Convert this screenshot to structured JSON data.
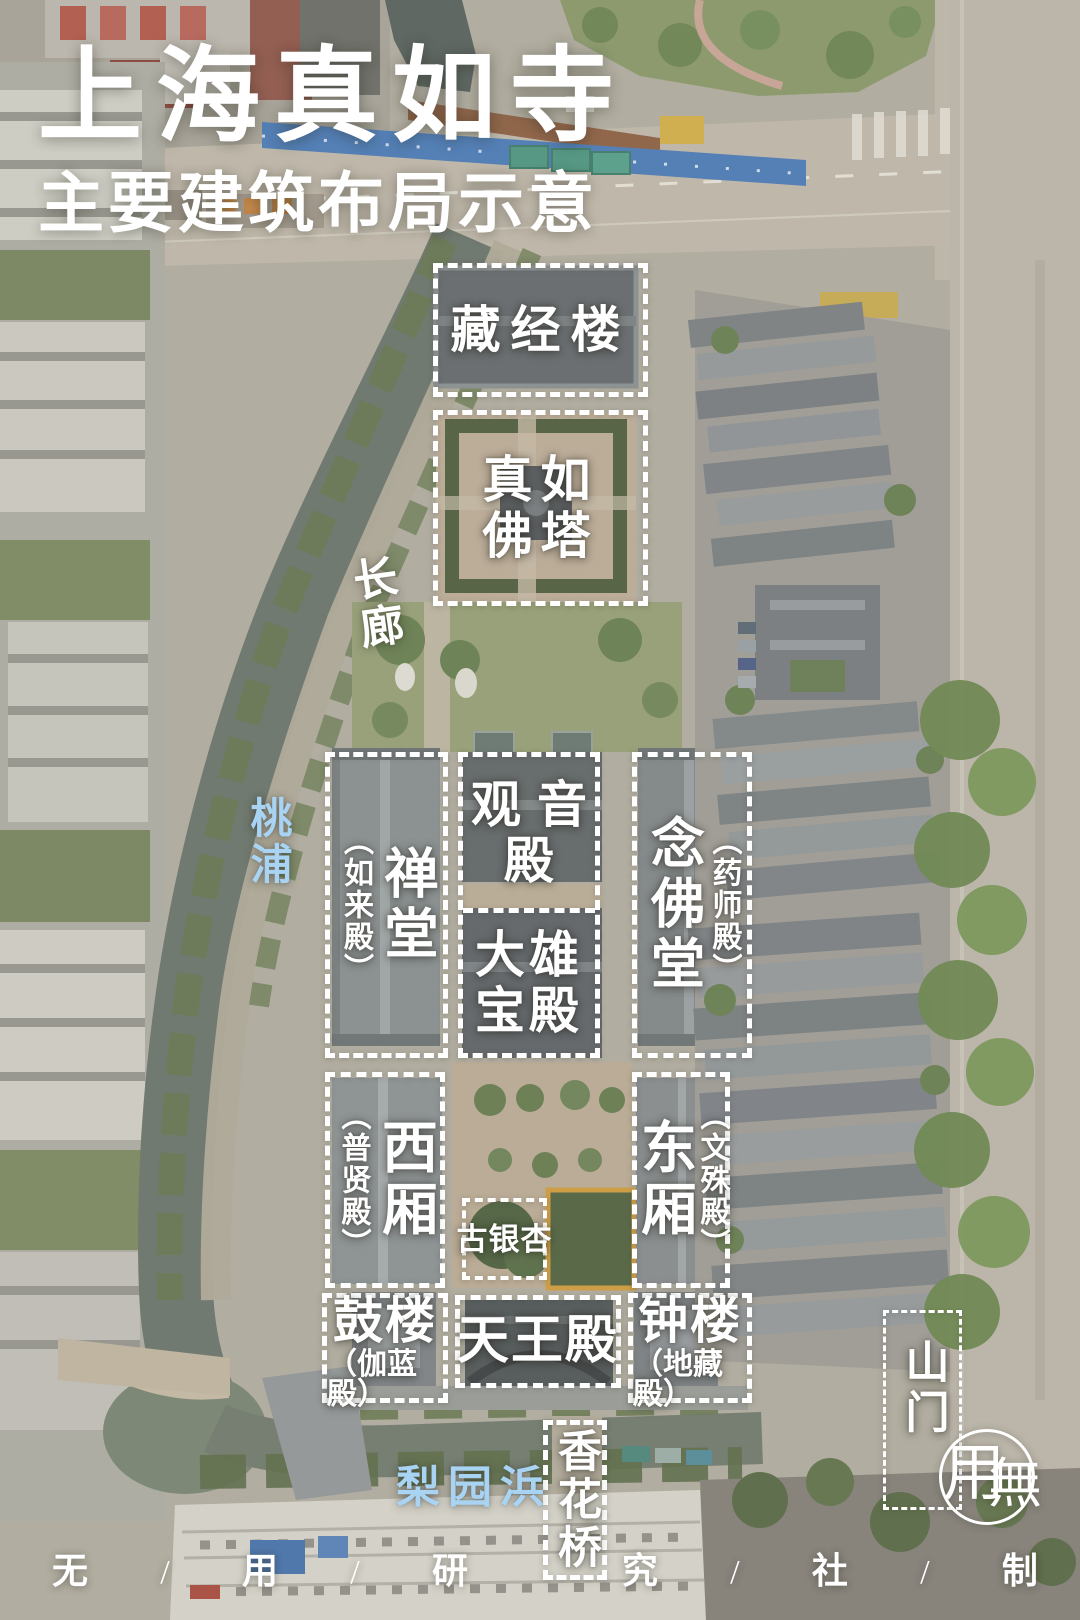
{
  "poster": {
    "title": "上海真如寺",
    "subtitle": "主要建筑布局示意"
  },
  "labels": {
    "sutra_library": "藏经楼",
    "pagoda_line1": "真如",
    "pagoda_line2": "佛塔",
    "corridor": "长廊",
    "taopu_river": "桃浦",
    "chan_hall": "禅堂",
    "chan_hall_alt": "（如来殿）",
    "guanyin_line1": "观音",
    "guanyin_line2": "殿",
    "nianfo_hall": "念佛堂",
    "nianfo_hall_alt": "（药师殿）",
    "mahavira_line1": "大雄",
    "mahavira_line2": "宝殿",
    "west_wing": "西厢",
    "west_wing_alt": "（普贤殿）",
    "east_wing": "东厢",
    "east_wing_alt": "（文殊殿）",
    "ginkgo": "古银杏",
    "drum_tower": "鼓楼",
    "drum_tower_alt": "（伽蓝殿）",
    "tianwang_hall": "天王殿",
    "bell_tower": "钟楼",
    "bell_tower_alt": "（地藏殿）",
    "mountain_gate": "山门",
    "xianghua_bridge": "香花桥",
    "liyuan_creek": "梨园浜"
  },
  "footer": {
    "items": [
      "无",
      "/",
      "用",
      "/",
      "研",
      "/",
      "究",
      "/",
      "社",
      "/",
      "制"
    ]
  },
  "logo": {
    "left_char": "用",
    "right_char": "無"
  },
  "colors": {
    "label": "#ffffff",
    "water_label": "#a8d3f2",
    "dash": "#ffffff"
  }
}
